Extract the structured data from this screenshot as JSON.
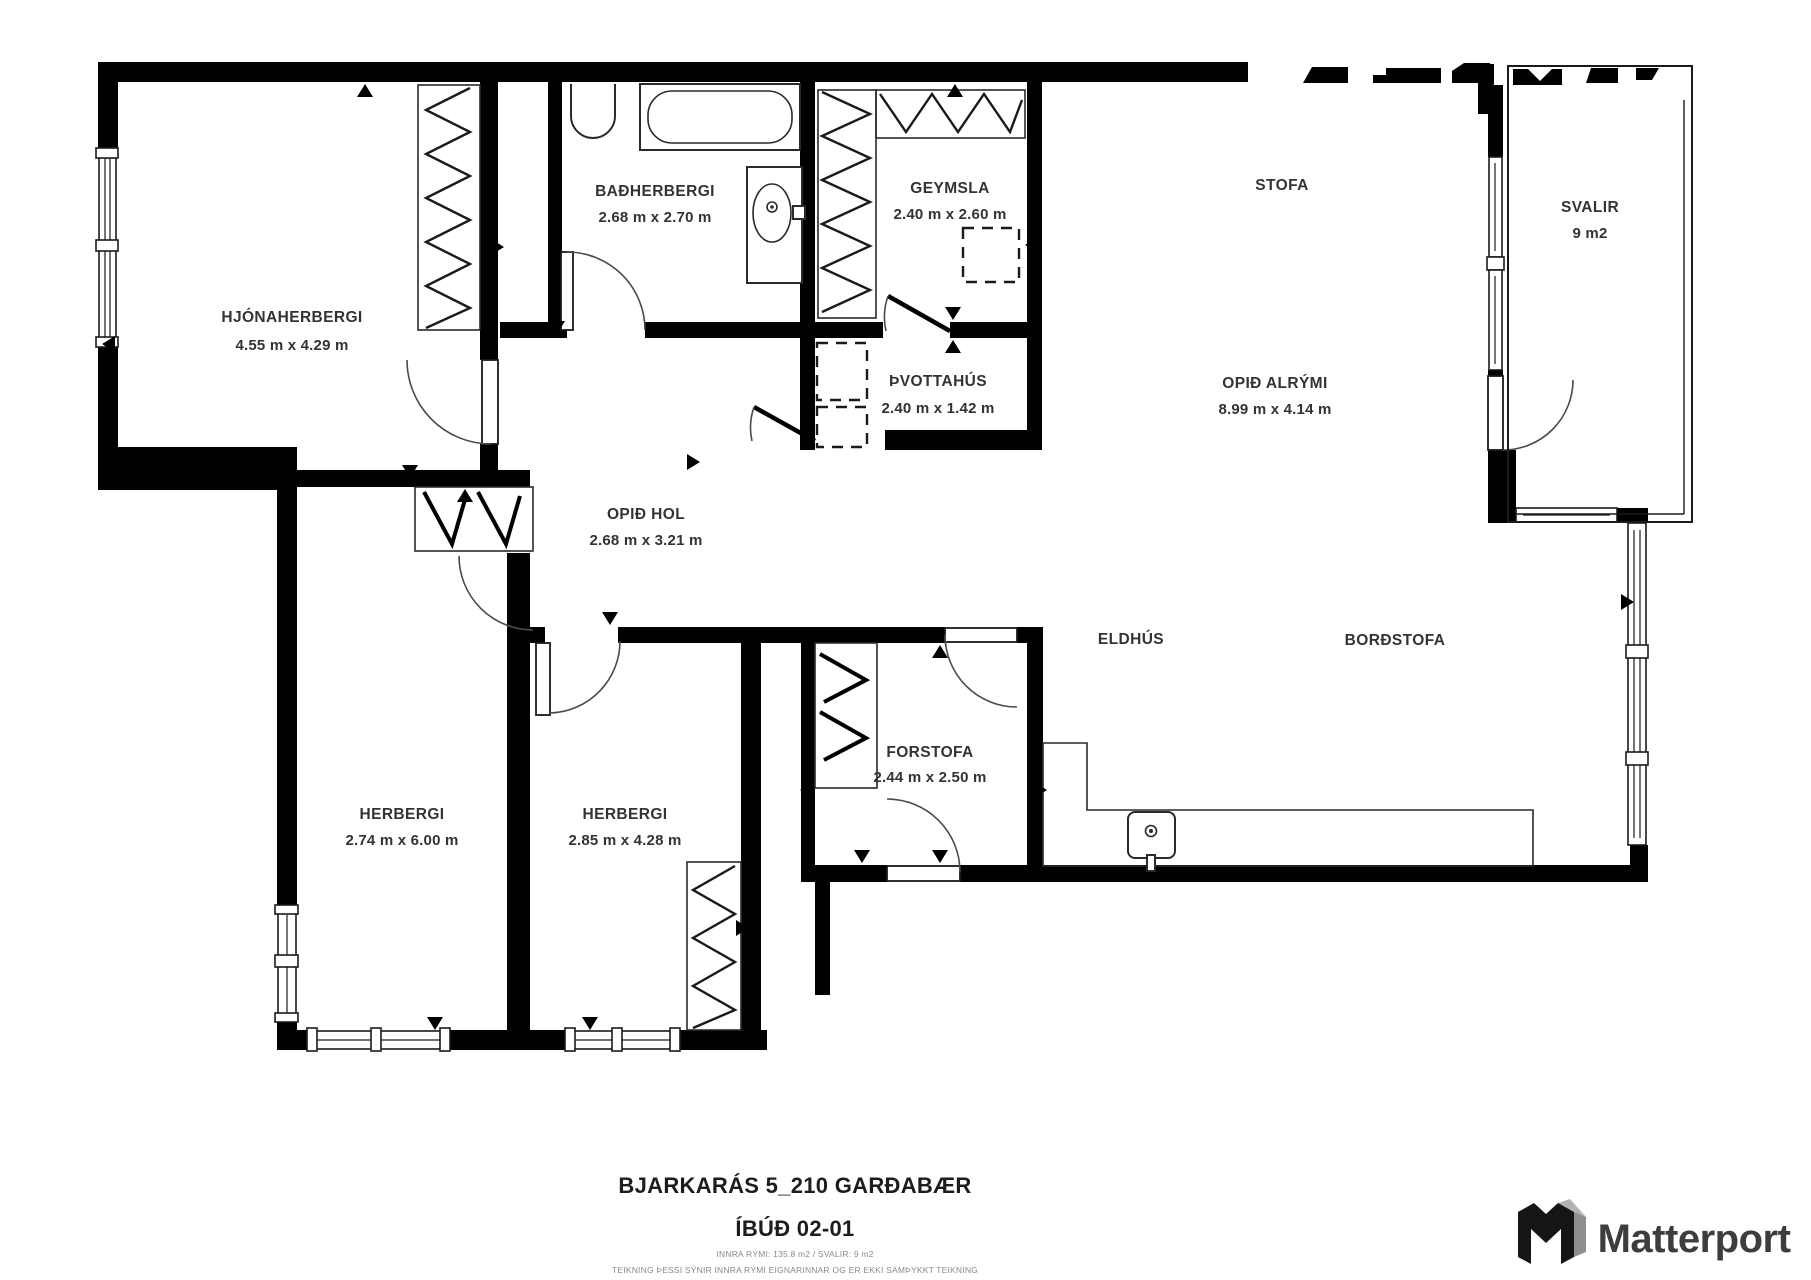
{
  "colors": {
    "background": "#ffffff",
    "walls": "#000000",
    "labels": "#333333",
    "fine_print": "#8a8a8a",
    "logo": "#3d3d3d"
  },
  "rooms": [
    {
      "id": "hjonaherbergi",
      "name": "HJÓNAHERBERGI",
      "dims": "4.55 m x 4.29 m"
    },
    {
      "id": "badherbergi",
      "name": "BAÐHERBERGI",
      "dims": "2.68 m x 2.70 m"
    },
    {
      "id": "geymsla",
      "name": "GEYMSLA",
      "dims": "2.40 m x 2.60 m"
    },
    {
      "id": "stofa",
      "name": "STOFA",
      "dims": ""
    },
    {
      "id": "svalir",
      "name": "SVALIR",
      "dims": "9 m2"
    },
    {
      "id": "thvottahus",
      "name": "ÞVOTTAHÚS",
      "dims": "2.40 m x 1.42 m"
    },
    {
      "id": "opid_alrymi",
      "name": "OPIÐ ALRÝMI",
      "dims": "8.99 m x 4.14 m"
    },
    {
      "id": "opid_hol",
      "name": "OPIÐ HOL",
      "dims": "2.68 m x 3.21 m"
    },
    {
      "id": "eldhus",
      "name": "ELDHÚS",
      "dims": ""
    },
    {
      "id": "bordstofa",
      "name": "BORÐSTOFA",
      "dims": ""
    },
    {
      "id": "forstofa",
      "name": "FORSTOFA",
      "dims": "2.44 m x 2.50 m"
    },
    {
      "id": "herbergi1",
      "name": "HERBERGI",
      "dims": "2.74 m x 6.00 m"
    },
    {
      "id": "herbergi2",
      "name": "HERBERGI",
      "dims": "2.85 m x 4.28 m"
    }
  ],
  "title": {
    "line1": "BJARKARÁS 5_210 GARÐABÆR",
    "line2": "ÍBÚÐ 02-01",
    "area_info": "INNRA RÝMI: 135.8 m2 / SVALIR: 9 m2",
    "disclaimer": "TEIKNING ÞESSI SÝNIR INNRA RÝMI EIGNARINNAR OG ER EKKI SAMÞYKKT TEIKNING"
  },
  "branding": {
    "logo_text": "Matterport",
    "logo_icon": "matterport-cube-icon"
  }
}
